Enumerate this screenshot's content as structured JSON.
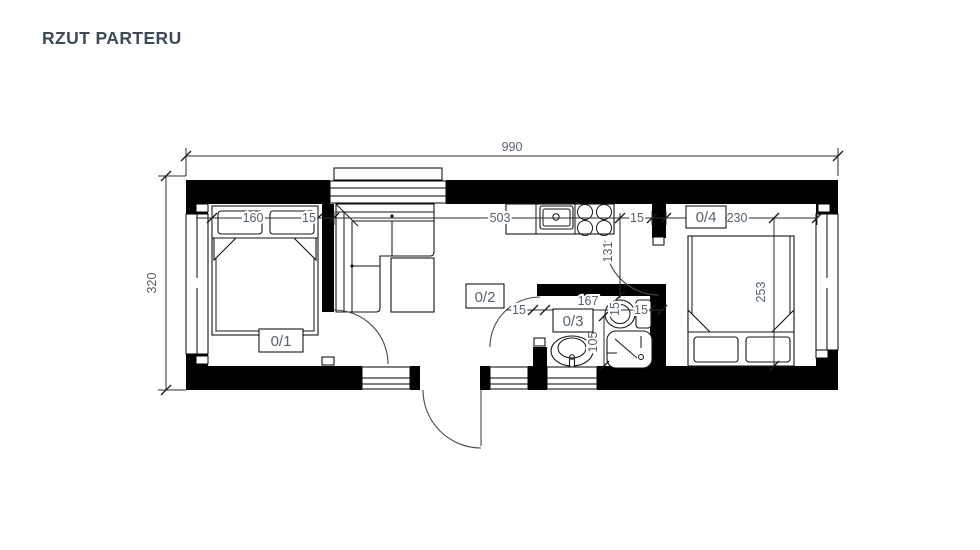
{
  "title": "RZUT PARTERU",
  "plan": {
    "rooms": {
      "r1": "0/1",
      "r2": "0/2",
      "r3": "0/3",
      "r4": "0/4"
    },
    "dims": {
      "total_width": "990",
      "total_height": "320",
      "bed_width": "160",
      "wall_a": "15",
      "living_width": "503",
      "wall_b": "15",
      "bedroom_width": "230",
      "passage_depth": "131",
      "bath_wall_left": "15",
      "bath_width": "167",
      "bath_wall_right_rot": "15",
      "bath_wall_right": "15",
      "shower_depth": "105",
      "bedroom_depth": "253"
    }
  }
}
